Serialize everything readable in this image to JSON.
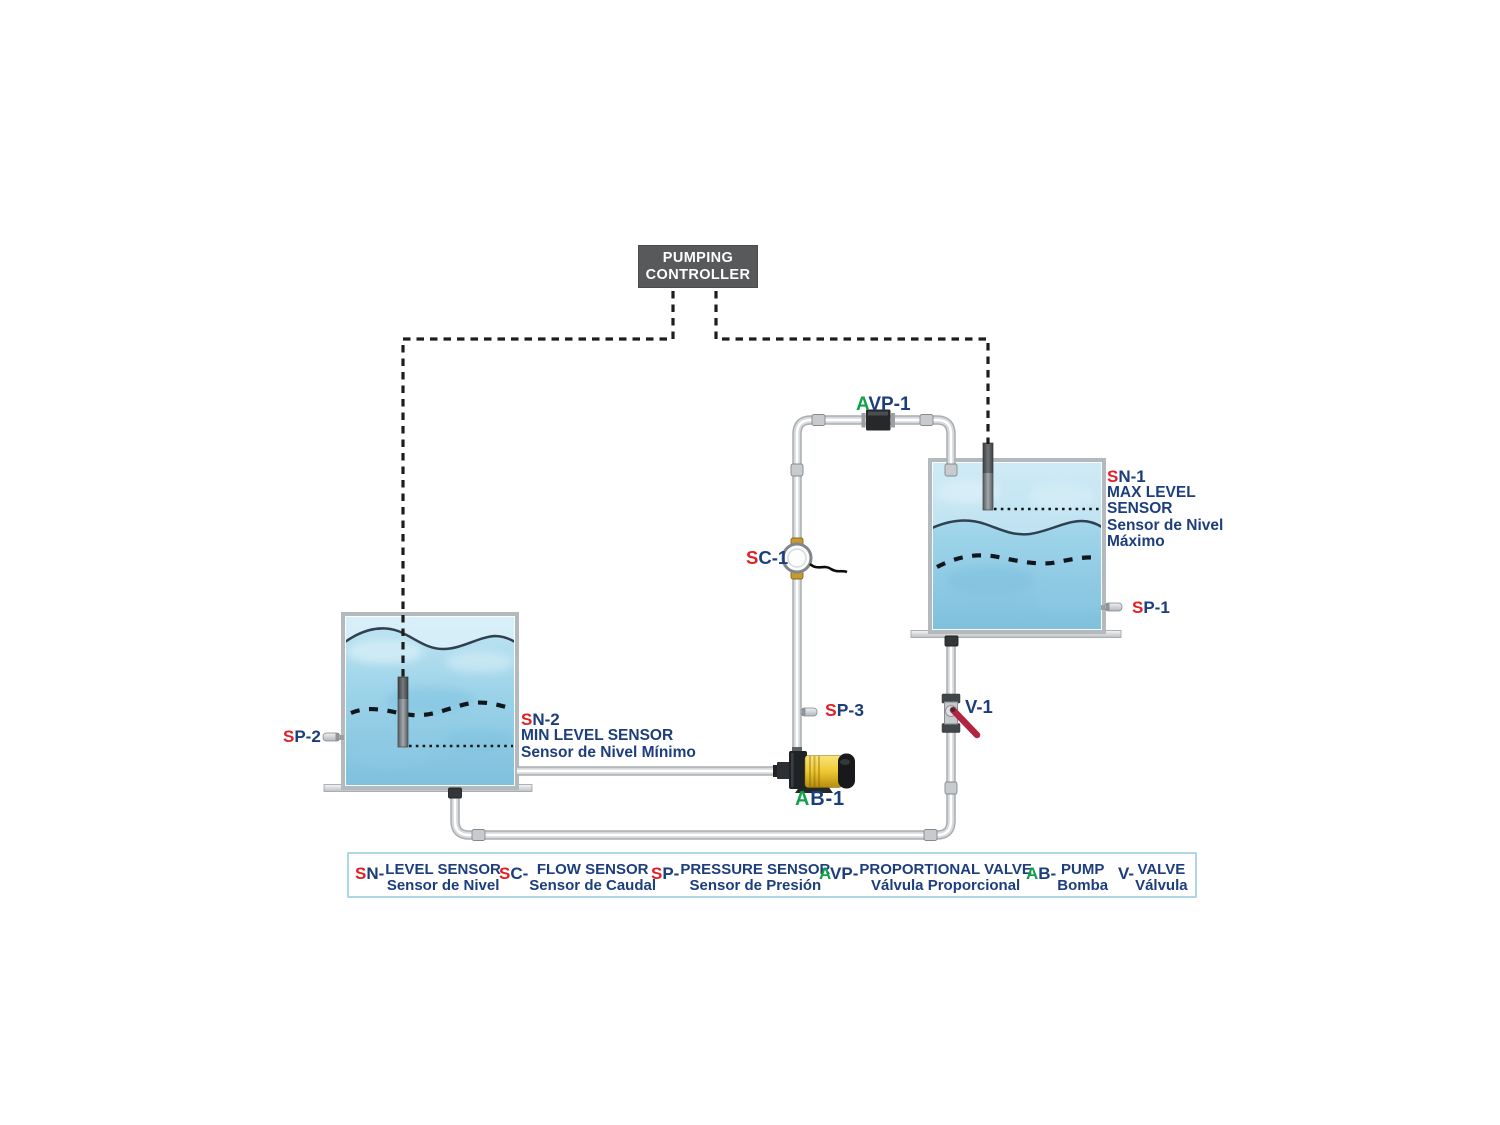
{
  "colors": {
    "red": "#e31e26",
    "green": "#12a14b",
    "navy": "#1d3e7d",
    "controller-bg": "#58595b",
    "valve-handle": "#b12540",
    "pump-yellow": "#eec832",
    "legend-border": "#b0d7e8",
    "water-top": "#c3e6f2",
    "water-bottom": "#7fc0dd"
  },
  "controller": {
    "line1": "PUMPING",
    "line2": "CONTROLLER"
  },
  "components": {
    "avp1": {
      "prefix": "A",
      "rest": "VP-1"
    },
    "sc1": {
      "prefix": "S",
      "rest": "C-1"
    },
    "sp3": {
      "prefix": "S",
      "rest": "P-3"
    },
    "ab1": {
      "prefix": "A",
      "rest": "B-1"
    },
    "v1": {
      "label": "V-1"
    },
    "sp1": {
      "prefix": "S",
      "rest": "P-1"
    },
    "sp2": {
      "prefix": "S",
      "rest": "P-2"
    },
    "sn1": {
      "prefix": "S",
      "rest": "N-1",
      "line1": "MAX LEVEL",
      "line2": "SENSOR",
      "line3": "Sensor de Nivel",
      "line4": "Máximo"
    },
    "sn2": {
      "prefix": "S",
      "rest": "N-2",
      "line1": "MIN LEVEL SENSOR",
      "line2": "Sensor de Nivel Mínimo"
    }
  },
  "legend": {
    "items": [
      {
        "prefix": "S",
        "rest": "N-",
        "en": "LEVEL SENSOR",
        "es": "Sensor de Nivel"
      },
      {
        "prefix": "S",
        "rest": "C-",
        "en": "FLOW SENSOR",
        "es": "Sensor de Caudal"
      },
      {
        "prefix": "S",
        "rest": "P-",
        "en": "PRESSURE SENSOR",
        "es": "Sensor de Presión"
      },
      {
        "prefix": "A",
        "rest": "VP-",
        "en": "PROPORTIONAL VALVE",
        "es": "Válvula Proporcional"
      },
      {
        "prefix": "A",
        "rest": "B-",
        "en": "PUMP",
        "es": "Bomba"
      },
      {
        "prefix": "V",
        "rest": "-",
        "en": "VALVE",
        "es": "Válvula"
      }
    ]
  }
}
